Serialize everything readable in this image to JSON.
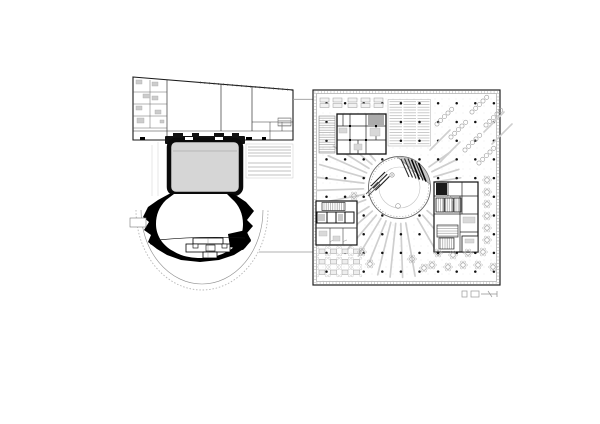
{
  "drawing": {
    "type": "architectural-floor-plan",
    "theatre_plan": {
      "label": "stage-house-and-horseshoe-auditorium"
    },
    "office_plan": {
      "label": "square-open-office-floor-with-central-atrium"
    },
    "scale_bar": {
      "present": true
    }
  },
  "colors": {
    "background": "#ffffff",
    "wall": "#1a1a1a",
    "poche": "#000000",
    "stage_fill": "#d6d6d6",
    "light_line": "#b5b5b5",
    "mid_line": "#8a8a8a",
    "furniture": "#d9d9d9",
    "ray": "#cfcfcf",
    "column_dot": "#111111",
    "atrium_gray": "#c6c6c6"
  },
  "office_generators": {
    "column_grid": {
      "x0": 326.5,
      "y0": 103.3,
      "dx": 18.6,
      "dy": 18.7,
      "nx": 10,
      "ny": 10,
      "r": 1.25
    },
    "atrium": {
      "cx": 399.5,
      "cy": 187.5,
      "r": 31
    },
    "ray_fans": [
      {
        "name": "east-upper",
        "angles": [
          -35,
          -26,
          -17,
          -9
        ],
        "r0": 36,
        "r1": 62
      },
      {
        "name": "south-east",
        "angles": [
          40,
          50,
          60
        ],
        "r0": 36,
        "r1": 78
      },
      {
        "name": "south",
        "angles": [
          80,
          88,
          96,
          104
        ],
        "r0": 36,
        "r1": 90
      },
      {
        "name": "south-west",
        "angles": [
          112,
          121,
          130,
          139,
          148
        ],
        "r0": 36,
        "r1": 80
      },
      {
        "name": "west",
        "angles": [
          160,
          169,
          178,
          187,
          196
        ],
        "r0": 36,
        "r1": 83
      },
      {
        "name": "north-west",
        "angles": [
          204,
          212,
          220,
          228
        ],
        "r0": 36,
        "r1": 78
      }
    ],
    "desk_groups": [
      [
        320,
        98
      ],
      [
        333,
        98
      ],
      [
        348,
        98
      ],
      [
        361,
        98
      ],
      [
        374,
        98
      ]
    ],
    "circle_chains": [
      {
        "x": 437,
        "y": 124
      },
      {
        "x": 451,
        "y": 137
      },
      {
        "x": 465,
        "y": 150
      },
      {
        "x": 479,
        "y": 163
      },
      {
        "x": 472,
        "y": 112
      },
      {
        "x": 486,
        "y": 125
      }
    ],
    "chain": {
      "count": 5,
      "step": 5.2,
      "angle": -45,
      "r": 2.1
    },
    "chain_lines": [
      [
        430,
        150
      ],
      [
        440,
        162
      ],
      [
        484,
        132
      ],
      [
        492,
        144
      ]
    ],
    "table_cluster": {
      "x0": 319,
      "y0": 249,
      "cols": 4,
      "rows": 3,
      "dx": 11.5,
      "dy": 10.5,
      "w": 6,
      "h": 4.5
    },
    "flower_tables": [
      [
        487,
        180
      ],
      [
        487,
        192
      ],
      [
        487,
        204
      ],
      [
        487,
        216
      ],
      [
        487,
        228
      ],
      [
        487,
        240
      ],
      [
        438,
        253
      ],
      [
        453,
        255
      ],
      [
        468,
        253
      ],
      [
        483,
        252
      ],
      [
        432,
        265
      ],
      [
        448,
        267
      ],
      [
        463,
        265
      ],
      [
        478,
        265
      ],
      [
        493,
        267
      ],
      [
        412,
        259
      ],
      [
        424,
        268
      ],
      [
        362,
        252
      ],
      [
        370,
        264
      ],
      [
        354,
        196
      ]
    ]
  }
}
